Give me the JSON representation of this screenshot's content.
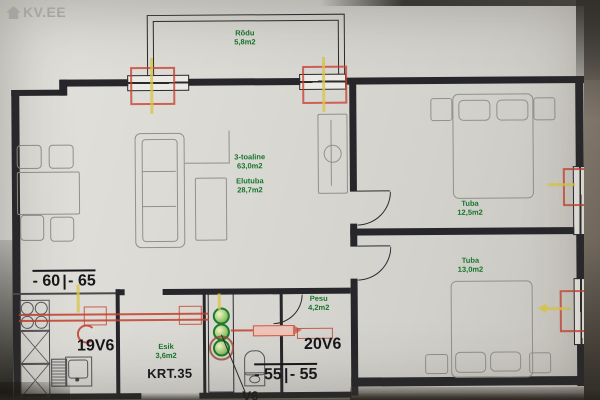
{
  "watermark": {
    "icon": "house-icon",
    "text": "KV.EE"
  },
  "summary": {
    "type_label": "3-toaline",
    "total_area": "63,0m2"
  },
  "rooms": {
    "balcony": {
      "name": "Rõdu",
      "area": "5,8m2"
    },
    "living": {
      "name": "Elutuba",
      "area": "28,7m2"
    },
    "bedroom1": {
      "name": "Tuba",
      "area": "12,5m2"
    },
    "bedroom2": {
      "name": "Tuba",
      "area": "13,0m2"
    },
    "hallway": {
      "name": "Esik",
      "area": "3,6m2"
    },
    "bathroom": {
      "name": "Pesu",
      "area": "4,2m2"
    }
  },
  "annotations": {
    "apartment_number": "KRT.35",
    "riser_left": "19V6",
    "riser_right": "20V6",
    "riser_bottom": "V6",
    "measure_top_left": {
      "a": "- 60",
      "b": "- 65"
    },
    "measure_bottom": {
      "a": "- 55",
      "b": "- 55"
    }
  },
  "palette": {
    "paper": "#d8d6d0",
    "wall": "#27272b",
    "furniture_line": "#91918b",
    "green_label": "#15752a",
    "red_mark": "#c43e2c",
    "yellow_mark": "#dac54e",
    "watermark_gray": "#a5a5a1"
  }
}
